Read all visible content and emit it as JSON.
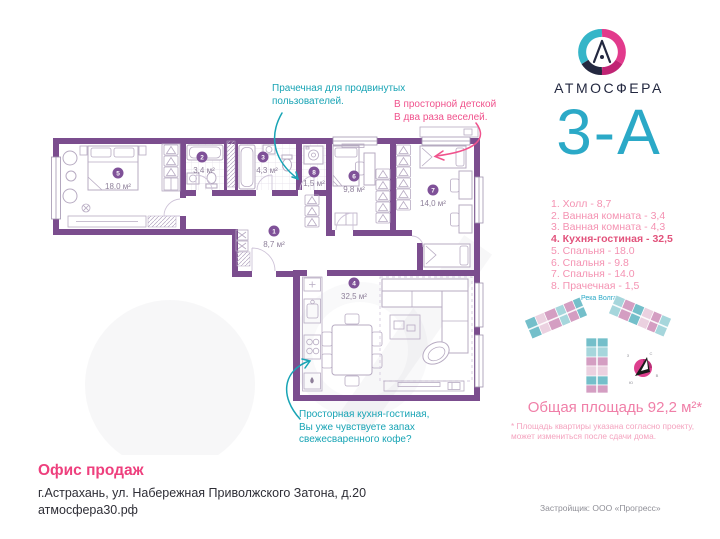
{
  "header": {
    "brand": "АТМОСФЕРА",
    "apartment_code": "3-А"
  },
  "room_list": [
    "1. Холл - 8,7",
    "2. Ванная комната - 3,4",
    "3. Ванная комната - 4,3",
    "4. Кухня-гостиная - 32,5",
    "5. Спальня - 18.0",
    "6. Спальня - 9.8",
    "7. Спальня - 14.0",
    "8. Прачечная - 1,5"
  ],
  "plan": {
    "rooms": {
      "r1": {
        "num": "1",
        "area": "8,7 м²"
      },
      "r2": {
        "num": "2",
        "area": "3,4 м²"
      },
      "r3": {
        "num": "3",
        "area": "4,3 м²"
      },
      "r4": {
        "num": "4",
        "area": "32,5 м²"
      },
      "r5": {
        "num": "5",
        "area": "18.0 м²"
      },
      "r6": {
        "num": "6",
        "area": "9,8 м²"
      },
      "r7": {
        "num": "7",
        "area": "14,0 м²"
      },
      "r8": {
        "num": "8",
        "area": "1,5 м²"
      }
    }
  },
  "annotations": {
    "laundry": "Прачечная для продвинутых\nпользователей.",
    "kids": "В просторной детской\nВ два раза веселей.",
    "kitchen": "Просторная кухня-гостиная,\nВы уже чувствуете запах\nсвежесваренного кофе?"
  },
  "site_plan": {
    "river": "Река Волга",
    "compass": {
      "n": "С",
      "e": "В",
      "s": "Ю",
      "w": "З"
    }
  },
  "summary": {
    "total_area": "Общая площадь 92,2 м²*",
    "footnote": "* Площадь квартиры указана согласно проекту,\nможет измениться после сдачи дома."
  },
  "footer": {
    "office": "Офис продаж",
    "address": "г.Астрахань, ул. Набережная Приволжского Затона, д.20",
    "website": "атмосфера30.рф",
    "developer": "Застройщик: ООО «Прогресс»"
  },
  "colors": {
    "accent_teal": "#2BA9C7",
    "annotation_teal": "#18A4B5",
    "accent_pink": "#EE3F7D",
    "annotation_pink": "#F0538D",
    "list_pink": "#F492B2",
    "list_highlight": "#E2537C",
    "summary_pink": "#F07FA8",
    "footnote_pink": "#F4A3BF",
    "wall_purple": "#7B4D8E",
    "badge_purple": "#7F5198",
    "area_label": "#8D7F99",
    "furniture_line": "#B7ABC2",
    "text_dark": "#2E2E36",
    "text_gray": "#8F8F97",
    "logo_navy": "#232840"
  }
}
